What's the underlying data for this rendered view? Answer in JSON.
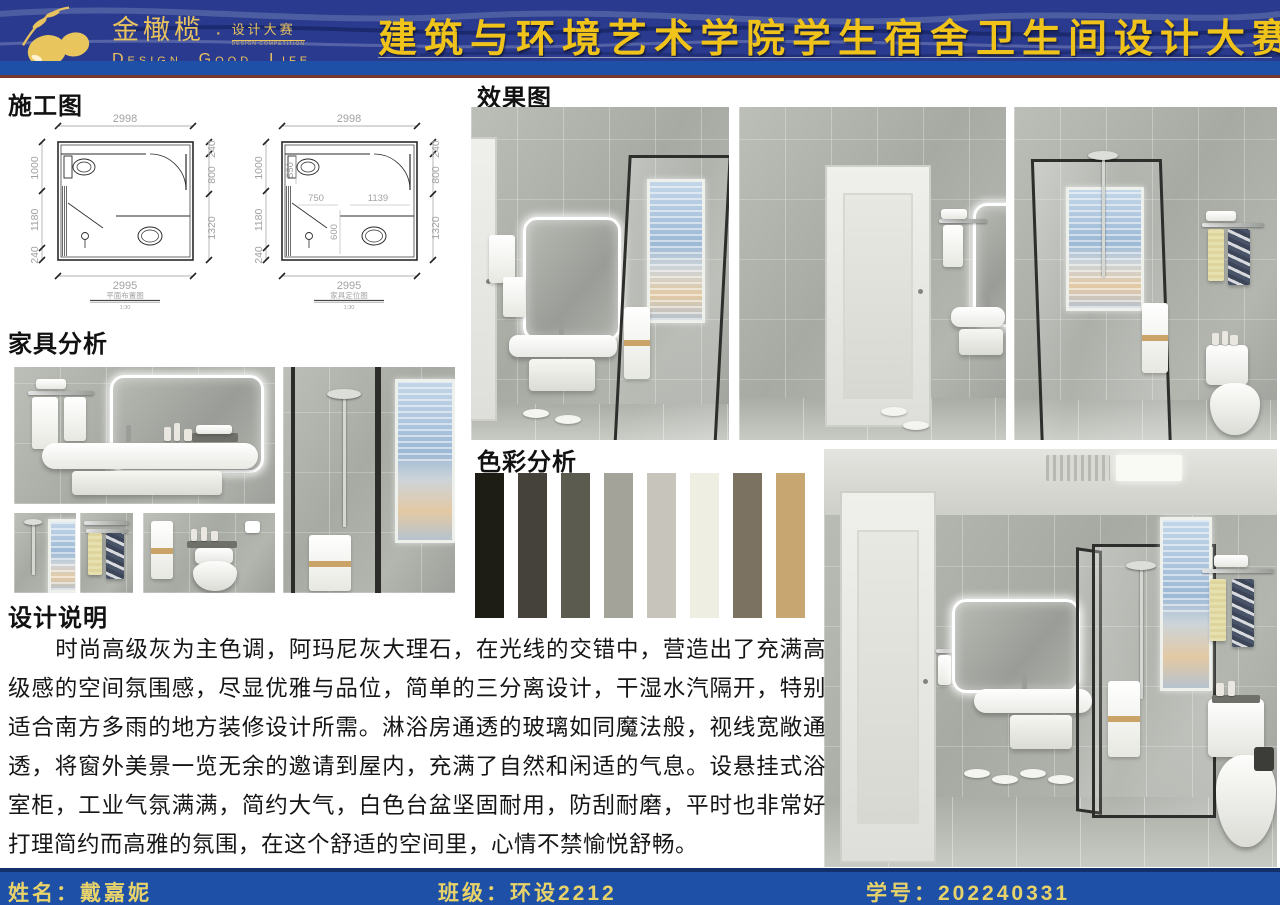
{
  "header": {
    "brand": "金橄榄",
    "brand_dot": "·",
    "brand_sub": "设计大赛",
    "brand_sub_en": "DESIGN COMPETITION",
    "tagline": "Design. Good. Life",
    "title": "建筑与环境艺术学院学生宿舍卫生间设计大赛"
  },
  "sections": {
    "construction_heading": "施工图",
    "renders_heading": "效果图",
    "furniture_heading": "家具分析",
    "color_heading": "色彩分析",
    "description_heading": "设计说明"
  },
  "plans": [
    {
      "caption": "平面布置图",
      "scale": "1:30",
      "top": "2998",
      "bottom": "2995",
      "left": [
        "1000",
        "1180",
        "240"
      ],
      "right": [
        "240",
        "800",
        "1320"
      ]
    },
    {
      "caption": "家具定位图",
      "scale": "1:30",
      "top": "2998",
      "bottom": "2995",
      "left": [
        "1000",
        "1180",
        "240"
      ],
      "right": [
        "240",
        "800",
        "1320"
      ],
      "inner": {
        "v1": "550",
        "h1": "750",
        "h2": "1139",
        "v2": "600"
      }
    }
  ],
  "color_analysis": {
    "swatches": [
      "#1d1d15",
      "#45423b",
      "#5c5b50",
      "#a4a39a",
      "#c7c4bb",
      "#efeee3",
      "#7c7262",
      "#c8a671"
    ]
  },
  "description": {
    "text": "时尚高级灰为主色调，阿玛尼灰大理石，在光线的交错中，营造出了充满高级感的空间氛围感，尽显优雅与品位，简单的三分离设计，干湿水汽隔开，特别适合南方多雨的地方装修设计所需。淋浴房通透的玻璃如同魔法般，视线宽敞通透，将窗外美景一览无余的邀请到屋内，充满了自然和闲适的气息。设悬挂式浴室柜，工业气氛满满，简约大气，白色台盆坚固耐用，防刮耐磨，平时也非常好打理简约而高雅的氛围，在这个舒适的空间里，心情不禁愉悦舒畅。"
  },
  "footer": {
    "name_label": "姓名：",
    "name_value": "戴嘉妮",
    "class_label": "班级：",
    "class_value": "环设2212",
    "id_label": "学号：",
    "id_value": "202240331"
  },
  "colors": {
    "header_navy": "#2a3a8e",
    "band_blue": "#1d50a6",
    "accent_maroon": "#74382c",
    "title_gold": "#f0c31b",
    "logo_gold": "#e7c25f",
    "footer_text": "#e8d36a"
  }
}
